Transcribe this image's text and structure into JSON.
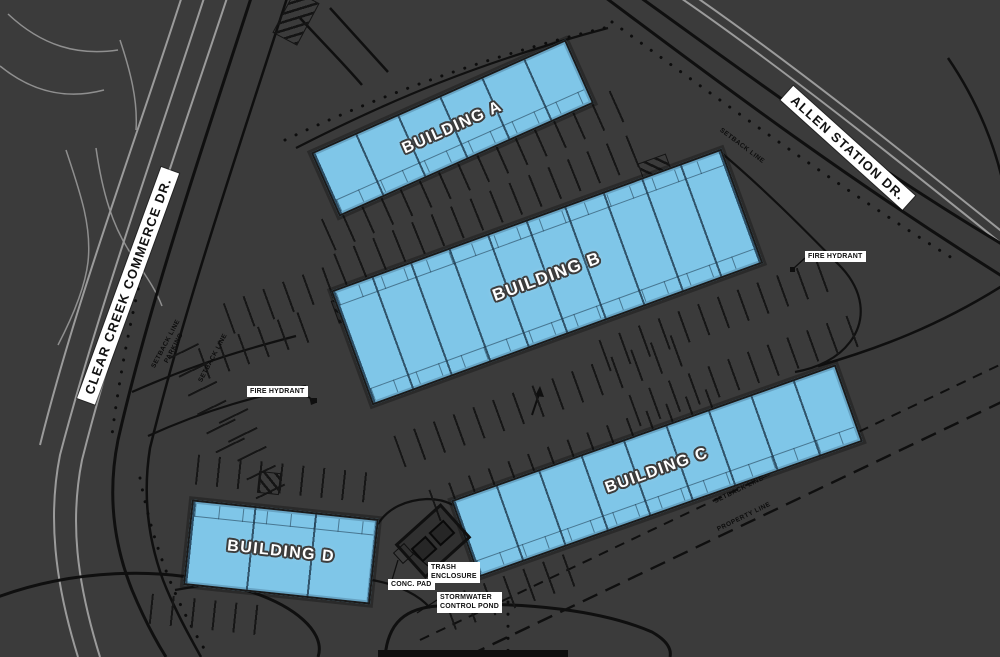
{
  "colors": {
    "background": "#3b3b3b",
    "building_fill": "#7fc6e8",
    "building_outline": "#1a1a1a",
    "linework_black": "#0f0f0f",
    "linework_gray": "#9b9b9b",
    "label_box_bg": "#ffffff",
    "label_text": "#0f0f0f",
    "building_label_text": "#ffffff"
  },
  "buildings": [
    {
      "id": "a",
      "label": "BUILDING A"
    },
    {
      "id": "b",
      "label": "BUILDING B"
    },
    {
      "id": "c",
      "label": "BUILDING C"
    },
    {
      "id": "d",
      "label": "BUILDING D"
    }
  ],
  "streets": {
    "west": "CLEAR CREEK COMMERCE DR.",
    "east": "ALLEN STATION DR."
  },
  "annotations": {
    "fire_hydrant_west": "FIRE HYDRANT",
    "fire_hydrant_east": "FIRE HYDRANT",
    "parking_setback": {
      "line1": "SETBACK LINE",
      "line2": "PARKING"
    },
    "setback_west": "SETBACK LINE",
    "setback_northeast": "SETBACK LINE",
    "setback_southeast": "SETBACK LINE",
    "property_line": "PROPERTY LINE",
    "trash_enclosure": {
      "line1": "TRASH",
      "line2": "ENCLOSURE"
    },
    "conc_pad": "CONC. PAD",
    "stormwater_pond": {
      "line1": "STORMWATER",
      "line2": "CONTROL POND"
    }
  }
}
